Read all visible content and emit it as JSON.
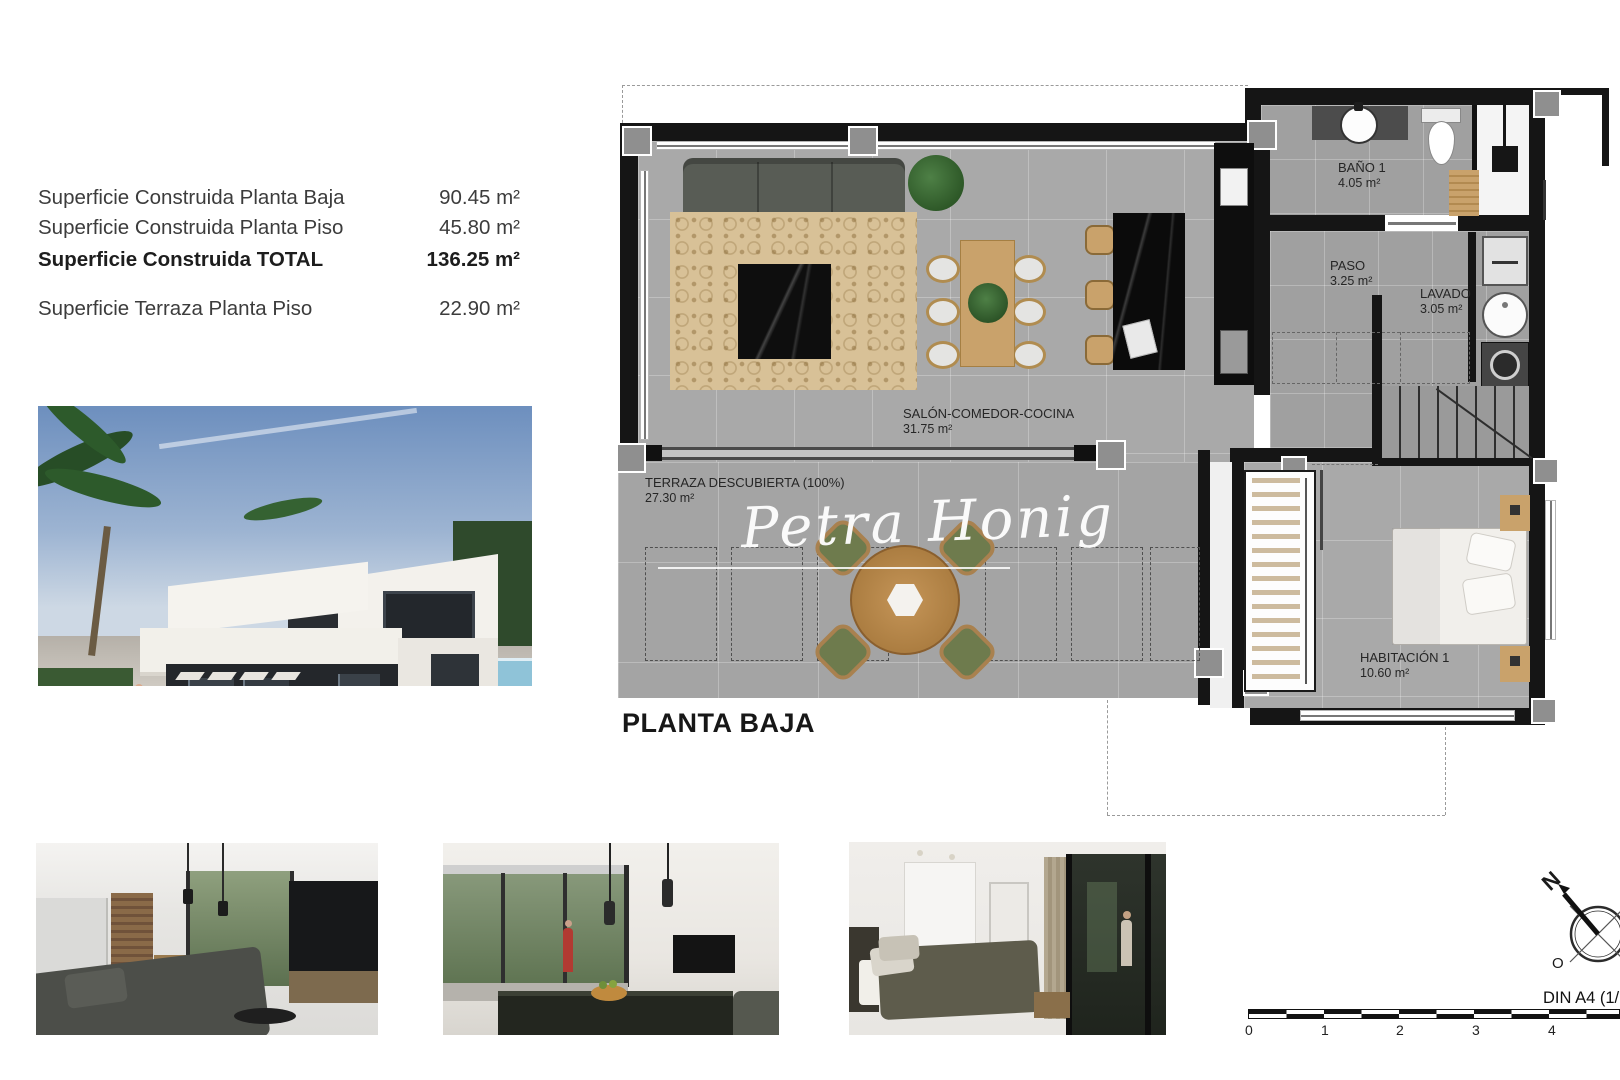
{
  "header_table": {
    "rows": [
      {
        "label": "Superficie Construida Planta Baja",
        "value": "90.45 m²"
      },
      {
        "label": "Superficie Construida Planta Piso",
        "value": "45.80 m²"
      },
      {
        "label": "Superficie Construida TOTAL",
        "value": "136.25 m²"
      },
      {
        "label": "Superficie Terraza Planta Piso",
        "value": "22.90 m²"
      }
    ]
  },
  "plan": {
    "title": "PLANTA BAJA",
    "watermark": "Petra Honig",
    "rooms": {
      "salon": {
        "name": "SALÓN-COMEDOR-COCINA",
        "area": "31.75 m²"
      },
      "terraza": {
        "name": "TERRAZA DESCUBIERTA (100%)",
        "area": "27.30 m²"
      },
      "bano": {
        "name": "BAÑO 1",
        "area": "4.05 m²"
      },
      "paso": {
        "name": "PASO",
        "area": "3.25 m²"
      },
      "lavado": {
        "name": "LAVADO",
        "area": "3.05 m²"
      },
      "habitacion": {
        "name": "HABITACIÓN 1",
        "area": "10.60 m²"
      }
    }
  },
  "footer": {
    "din_label": "DIN A4 (1/7",
    "scale_ticks": [
      "0",
      "1",
      "2",
      "3",
      "4"
    ],
    "compass": {
      "n": "N",
      "o": "O",
      "s": "S"
    }
  },
  "colors": {
    "wall": "#151515",
    "floor_tile": "#a9a9a9",
    "terrace_tile": "#a4a4a4",
    "wood": "#c9a26b",
    "rug": "#d8c197",
    "watermark_text": "#ffffff"
  }
}
